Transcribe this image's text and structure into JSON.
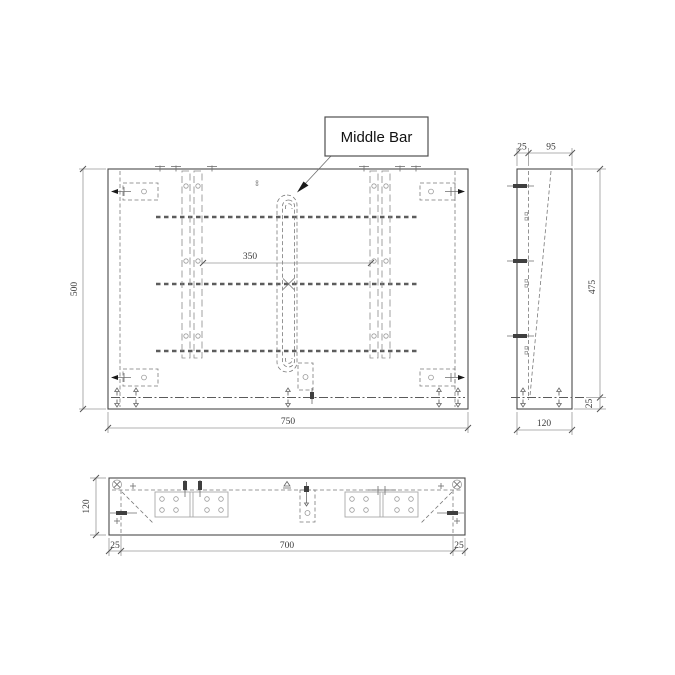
{
  "title": "Middle bar panel technical drawing",
  "callout": {
    "label": "Middle Bar"
  },
  "front_view": {
    "width_label": "750",
    "height_label": "500",
    "middle_span_label": "350"
  },
  "side_view": {
    "wall_label": "25",
    "web_label": "95",
    "height_label": "475",
    "bottom_label": "25",
    "depth_label": "120"
  },
  "bottom_view": {
    "depth_label": "120",
    "left_margin_label": "25",
    "inner_width_label": "700",
    "right_margin_label": "25"
  }
}
